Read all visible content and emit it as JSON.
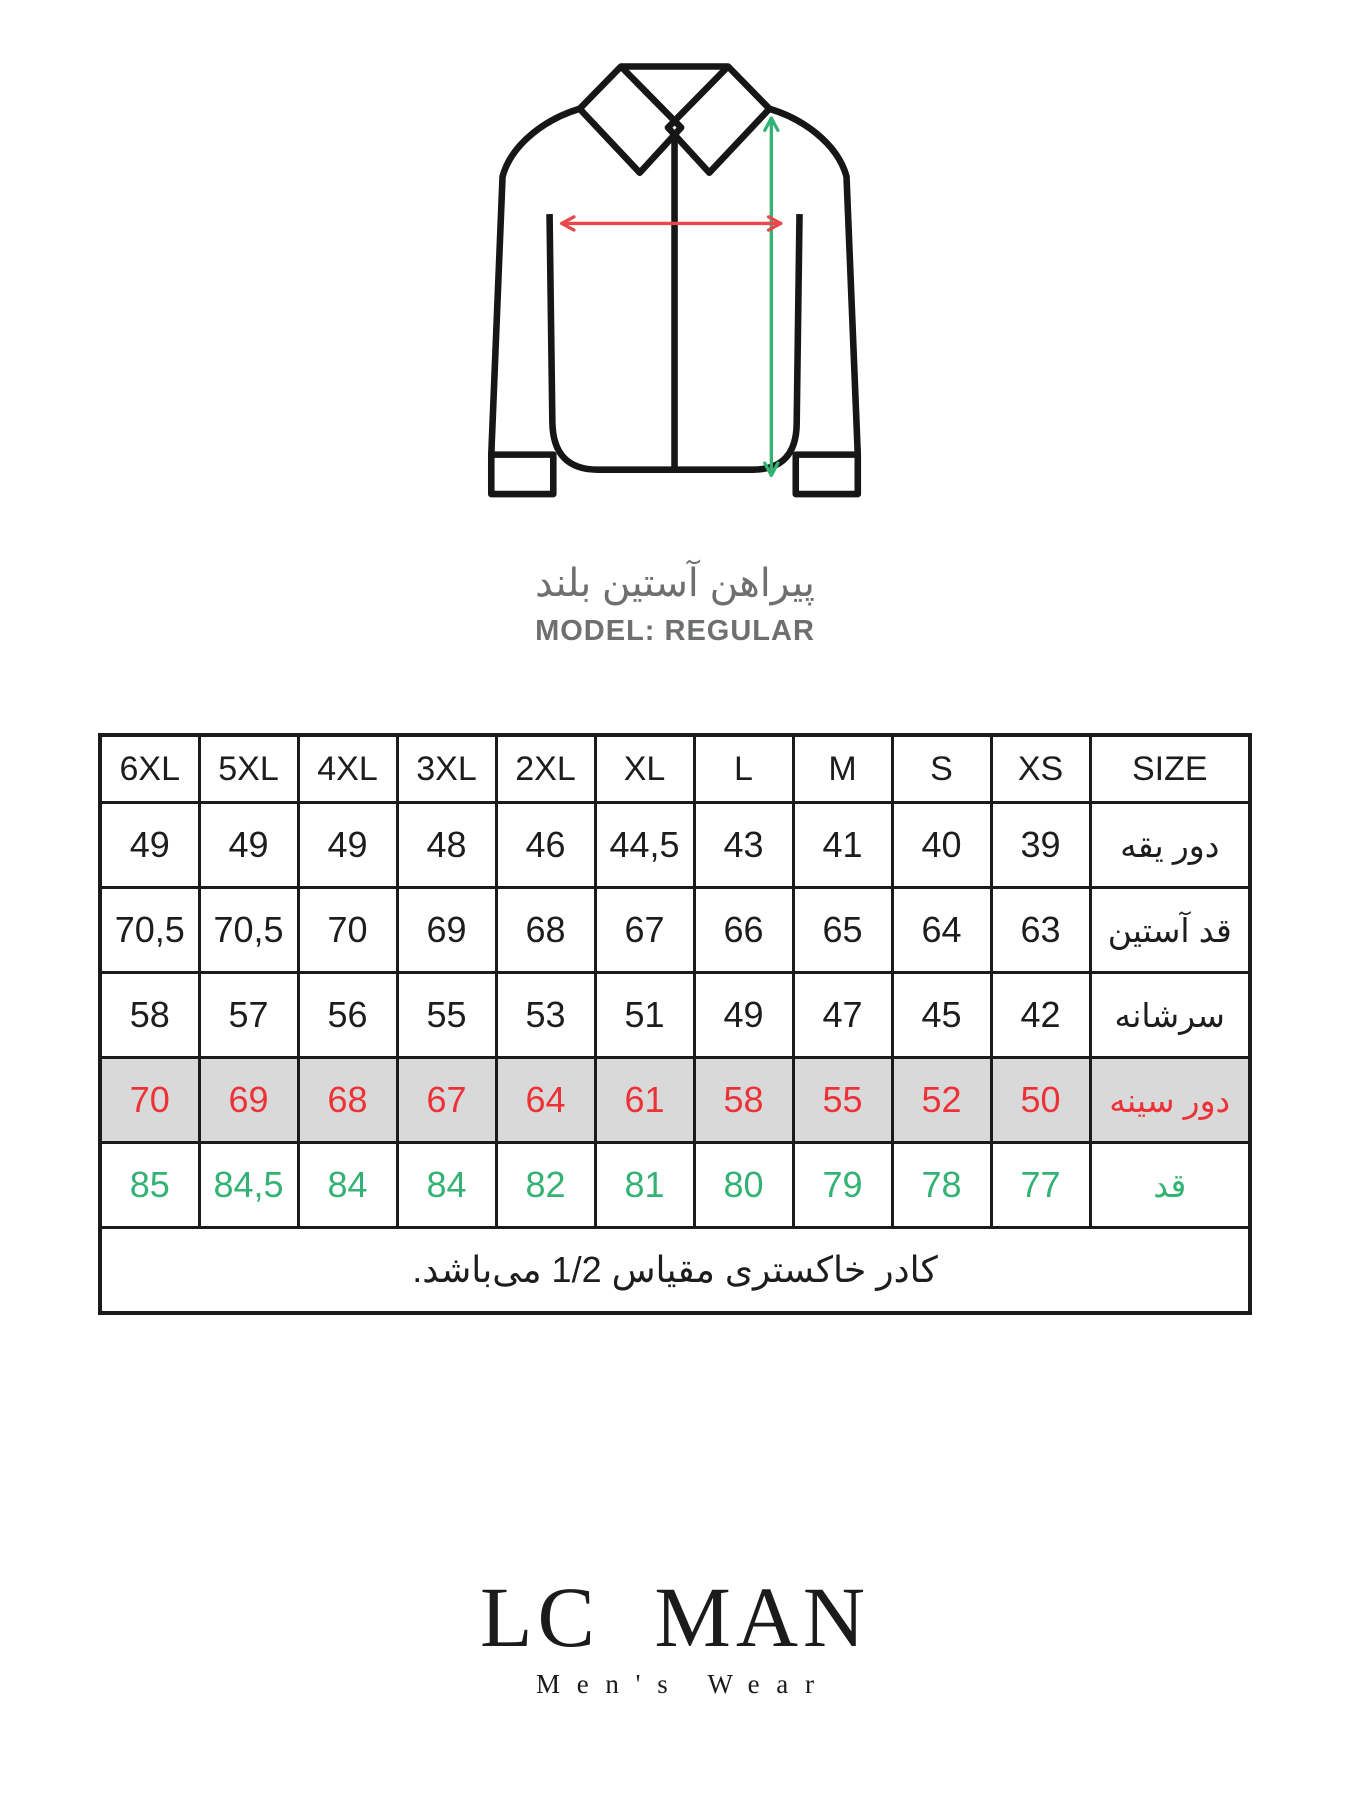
{
  "accent_colors": {
    "red": "#ed3237",
    "green": "#33b273",
    "row_gray": "#d9d9d9",
    "line_black": "#1b1b1b",
    "muted_gray": "#6e6f71"
  },
  "icons": {
    "shirt": "long-sleeve-shirt-outline-icon",
    "red_arrow": "chest-width-arrow-icon",
    "green_arrow": "shirt-length-arrow-icon"
  },
  "figure": {
    "title_fa": "پیراهن آستین بلند",
    "model_label": "MODEL: REGULAR"
  },
  "table": {
    "header": [
      "6XL",
      "5XL",
      "4XL",
      "3XL",
      "2XL",
      "XL",
      "L",
      "M",
      "S",
      "XS",
      "SIZE"
    ],
    "rows": [
      {
        "label": "دور یقه",
        "values": [
          "49",
          "49",
          "49",
          "48",
          "46",
          "44,5",
          "43",
          "41",
          "40",
          "39"
        ]
      },
      {
        "label": "قد آستین",
        "values": [
          "70,5",
          "70,5",
          "70",
          "69",
          "68",
          "67",
          "66",
          "65",
          "64",
          "63"
        ]
      },
      {
        "label": "سرشانه",
        "values": [
          "58",
          "57",
          "56",
          "55",
          "53",
          "51",
          "49",
          "47",
          "45",
          "42"
        ]
      },
      {
        "label": "دور سینه",
        "values": [
          "70",
          "69",
          "68",
          "67",
          "64",
          "61",
          "58",
          "55",
          "52",
          "50"
        ]
      },
      {
        "label": "قد",
        "values": [
          "85",
          "84,5",
          "84",
          "84",
          "82",
          "81",
          "80",
          "79",
          "78",
          "77"
        ]
      }
    ],
    "note": "کادر خاکستری مقیاس 1/2 می‌باشد."
  },
  "logo": {
    "brand": "LC MAN",
    "tagline": "Men's Wear"
  },
  "chart_data": {
    "type": "table",
    "title": "پیراهن آستین بلند — MODEL: REGULAR",
    "direction": "rtl",
    "sizes": [
      "XS",
      "S",
      "M",
      "L",
      "XL",
      "2XL",
      "3XL",
      "4XL",
      "5XL",
      "6XL"
    ],
    "measurements": [
      {
        "label_fa": "دور یقه",
        "label_en": "collar",
        "values": [
          39,
          40,
          41,
          43,
          44.5,
          46,
          48,
          49,
          49,
          49
        ]
      },
      {
        "label_fa": "قد آستین",
        "label_en": "sleeve length",
        "values": [
          63,
          64,
          65,
          66,
          67,
          68,
          69,
          70,
          70.5,
          70.5
        ]
      },
      {
        "label_fa": "سرشانه",
        "label_en": "shoulder",
        "values": [
          42,
          45,
          47,
          49,
          51,
          53,
          55,
          56,
          57,
          58
        ]
      },
      {
        "label_fa": "دور سینه",
        "label_en": "chest",
        "values": [
          50,
          52,
          55,
          58,
          61,
          64,
          67,
          68,
          69,
          70
        ],
        "highlighted": true,
        "text_color": "red",
        "row_bg": "gray"
      },
      {
        "label_fa": "قد",
        "label_en": "length",
        "values": [
          77,
          78,
          79,
          80,
          81,
          82,
          84,
          84,
          84.5,
          85
        ],
        "text_color": "green"
      }
    ],
    "note_fa": "کادر خاکستری مقیاس 1/2 می‌باشد."
  }
}
